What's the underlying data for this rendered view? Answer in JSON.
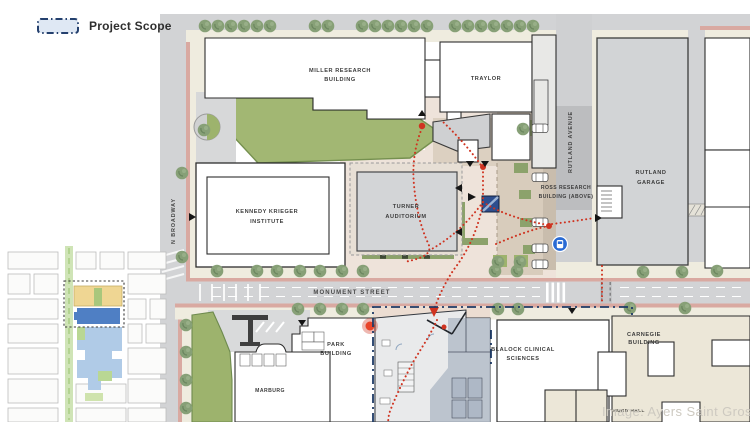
{
  "legend": {
    "label": "Project Scope"
  },
  "map": {
    "buildings": {
      "miller": {
        "l1": "MILLER RESEARCH",
        "l2": "BUILDING"
      },
      "traylor": {
        "l1": "TRAYLOR"
      },
      "kennedy": {
        "l1": "KENNEDY KRIEGER",
        "l2": "INSTITUTE"
      },
      "turner": {
        "l1": "TURNER",
        "l2": "AUDITORIUM"
      },
      "ross": {
        "l1": "ROSS RESEARCH",
        "l2": "BUILDING (ABOVE)"
      },
      "garage": {
        "l1": "RUTLAND",
        "l2": "GARAGE"
      },
      "park": {
        "l1": "PARK",
        "l2": "BUILDING"
      },
      "marburg": {
        "l1": "MARBURG"
      },
      "blalock": {
        "l1": "BLALOCK CLINICAL",
        "l2": "SCIENCES"
      },
      "carnegie": {
        "l1": "CARNEGIE",
        "l2": "BUILDING"
      },
      "hurd": {
        "l1": "HURD HALL"
      }
    },
    "streets": {
      "monument": "MONUMENT STREET",
      "broadway": "N BROADWAY",
      "rutland": "RUTLAND AVENUE"
    },
    "credit": "Image: Ayers Saint Gross",
    "colors": {
      "scope_blue": "#1e3a66",
      "path_red": "#cf3320",
      "bus_blue": "#2a6bd4",
      "lawn_green": "#a2b773",
      "highlight_yellow": "#efd693",
      "highlight_blue": "#4f7fc4"
    }
  }
}
